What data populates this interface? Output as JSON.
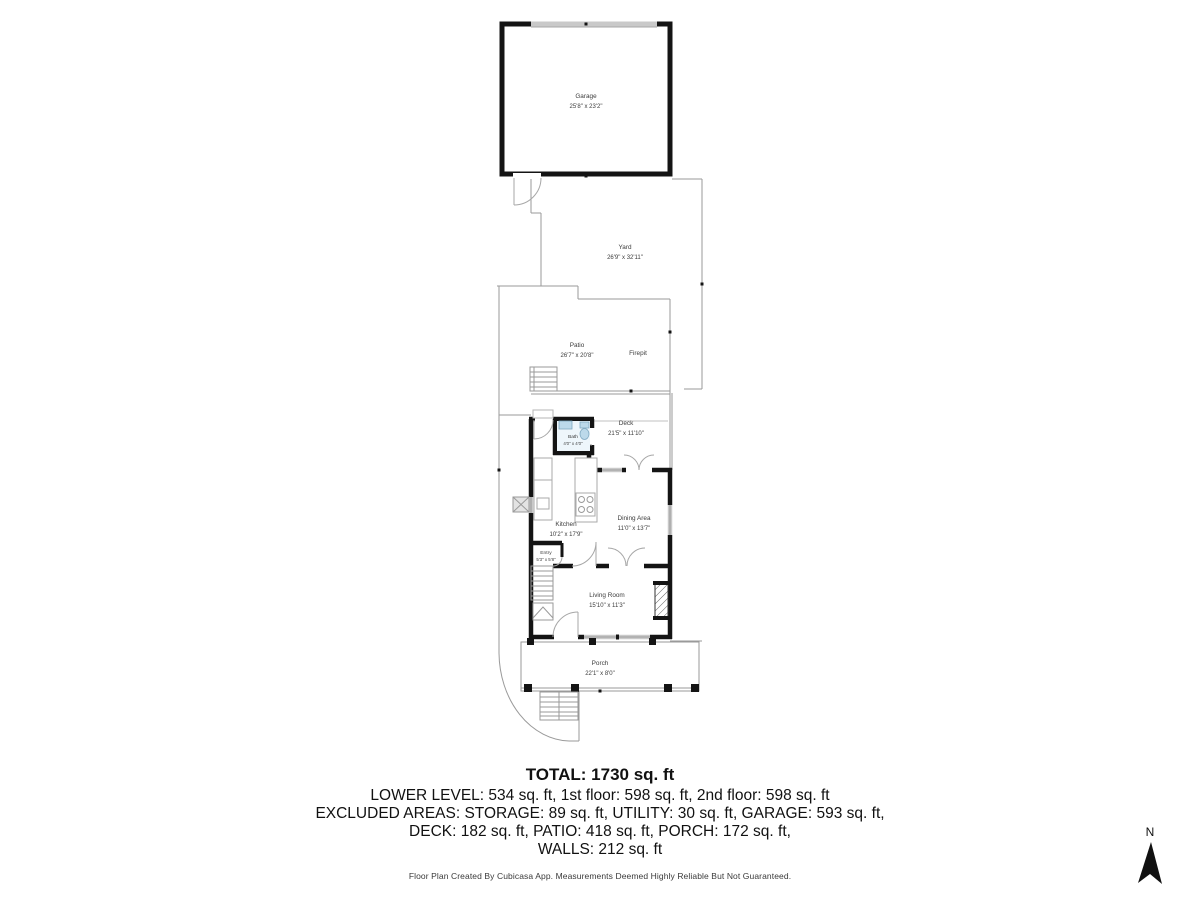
{
  "rooms": {
    "garage": {
      "name": "Garage",
      "dims": "25'8\" x 23'2\""
    },
    "yard": {
      "name": "Yard",
      "dims": "26'9\" x 32'11\""
    },
    "patio": {
      "name": "Patio",
      "dims": "26'7\" x 20'8\""
    },
    "firepit": {
      "name": "Firepit"
    },
    "deck": {
      "name": "Deck",
      "dims": "21'5\" x 11'10\""
    },
    "bath": {
      "name": "Bath",
      "dims": "4'0\" x 4'0\""
    },
    "kitchen": {
      "name": "Kitchen",
      "dims": "10'2\" x 17'9\""
    },
    "dining": {
      "name": "Dining Area",
      "dims": "11'0\" x 13'7\""
    },
    "entry": {
      "name": "Entry",
      "dims": "5'3\" x 5'8\""
    },
    "living": {
      "name": "Living Room",
      "dims": "15'10\" x 11'3\""
    },
    "porch": {
      "name": "Porch",
      "dims": "22'1\" x 8'0\""
    }
  },
  "summary": {
    "total": "TOTAL: 1730 sq. ft",
    "line1": "LOWER LEVEL: 534 sq. ft, 1st floor: 598 sq. ft, 2nd floor: 598 sq. ft",
    "line2": "EXCLUDED AREAS: STORAGE: 89 sq. ft, UTILITY: 30 sq. ft, GARAGE: 593 sq. ft,",
    "line3": "DECK: 182 sq. ft, PATIO: 418 sq. ft, PORCH: 172 sq. ft,",
    "line4": "WALLS: 212 sq. ft"
  },
  "footer": "Floor Plan Created By Cubicasa App. Measurements Deemed Highly Reliable But Not Guaranteed.",
  "compass": {
    "label": "N"
  },
  "colors": {
    "wall": "#141414",
    "outline": "#9a9a9a",
    "window": "#c9c9c9",
    "bath_fixture": "#bcd9ea",
    "background": "#ffffff"
  }
}
